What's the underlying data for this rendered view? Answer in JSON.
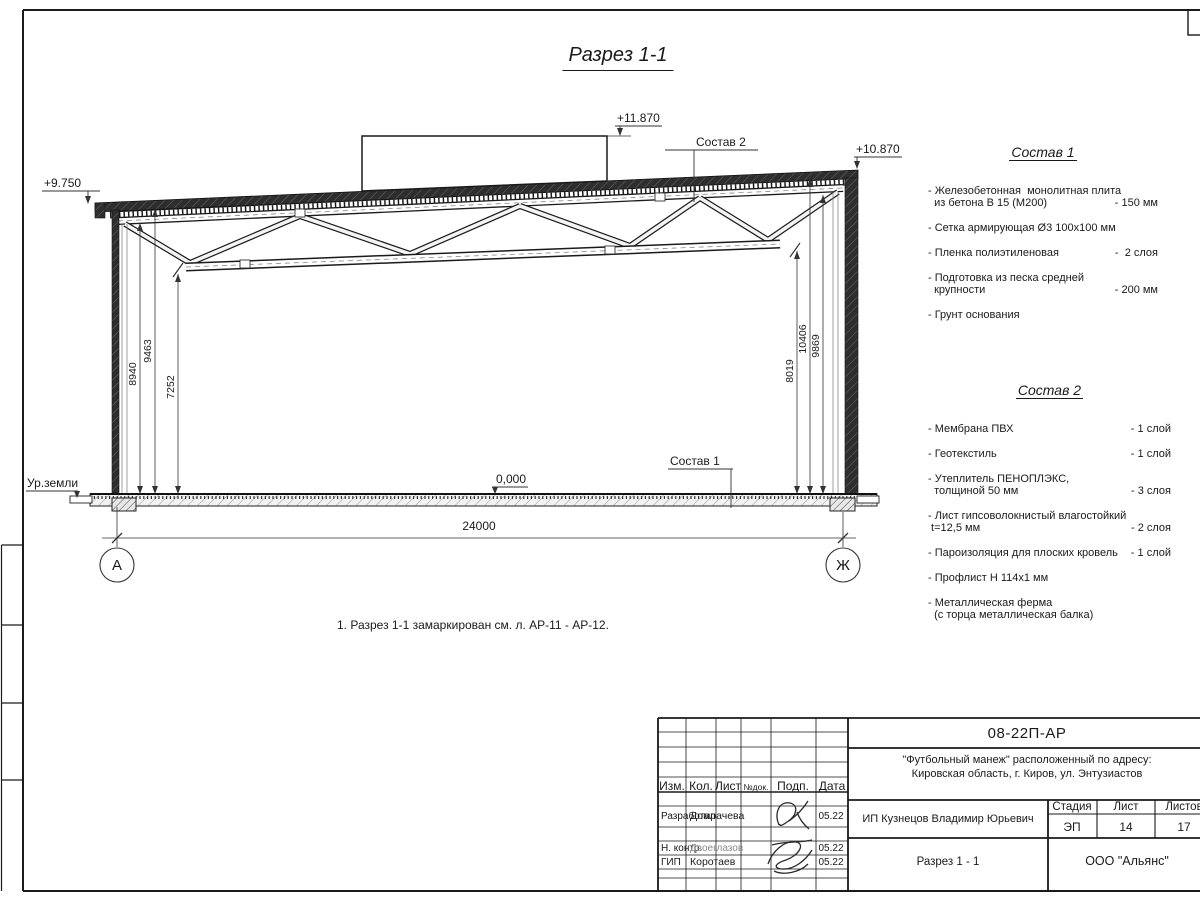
{
  "sheet": {
    "title": "Разрез 1-1",
    "note": "1. Разрез 1-1 замаркирован см. л. АР-11 - АР-12."
  },
  "drawing": {
    "elevations": {
      "left": "+9.750",
      "box": "+11.870",
      "right": "+10.870",
      "zero": "0,000"
    },
    "labels": {
      "ground": "Ур.земли",
      "sostav1_ref": "Состав 1",
      "sostav2_ref": "Состав 2"
    },
    "dims": {
      "span": "24000",
      "left": [
        "8940",
        "9463",
        "7252"
      ],
      "right": [
        "8019",
        "10406",
        "9869"
      ]
    },
    "axes": {
      "left": "А",
      "right": "Ж"
    }
  },
  "sostav1": {
    "title": "Состав 1",
    "items": [
      {
        "rows": [
          {
            "t": "- Железобетонная  монолитная плита",
            "q": ""
          },
          {
            "t": "  из бетона В 15 (М200)",
            "q": "- 150 мм"
          }
        ]
      },
      {
        "rows": [
          {
            "t": "- Сетка армирующая Ø3 100х100 мм",
            "q": ""
          }
        ]
      },
      {
        "rows": [
          {
            "t": "- Пленка полиэтиленовая",
            "q": "-  2 слоя"
          }
        ]
      },
      {
        "rows": [
          {
            "t": "- Подготовка из песка средней",
            "q": ""
          },
          {
            "t": "  крупности",
            "q": "- 200 мм"
          }
        ]
      },
      {
        "rows": [
          {
            "t": "- Грунт основания",
            "q": ""
          }
        ]
      }
    ]
  },
  "sostav2": {
    "title": "Состав 2",
    "items": [
      {
        "rows": [
          {
            "t": "- Мембрана ПВХ",
            "q": "- 1 слой"
          }
        ]
      },
      {
        "rows": [
          {
            "t": "- Геотекстиль",
            "q": "- 1 слой"
          }
        ]
      },
      {
        "rows": [
          {
            "t": "- Утеплитель ПЕНОПЛЭКС,",
            "q": ""
          },
          {
            "t": "  толщиной 50 мм",
            "q": "- 3 слоя"
          }
        ]
      },
      {
        "rows": [
          {
            "t": "- Лист гипсоволокнистый влагостойкий",
            "q": ""
          },
          {
            "t": " t=12,5 мм",
            "q": "- 2 слоя"
          }
        ]
      },
      {
        "rows": [
          {
            "t": "- Пароизоляция для плоских кровель",
            "q": "- 1 слой"
          }
        ]
      },
      {
        "rows": [
          {
            "t": "- Профлист Н 114х1 мм",
            "q": ""
          }
        ]
      },
      {
        "rows": [
          {
            "t": "- Металлическая ферма",
            "q": ""
          },
          {
            "t": "  (с торца металлическая балка)",
            "q": ""
          }
        ]
      }
    ]
  },
  "titleblock": {
    "doc_code": "08-22П-АР",
    "project_line1": "\"Футбольный манеж\" расположенный по адресу:",
    "project_line2": "Кировская область, г. Киров, ул. Энтузиастов",
    "cols": {
      "izm": "Изм.",
      "kol": "Кол.",
      "list": "Лист",
      "ndok": "№док.",
      "podp": "Подп.",
      "data": "Дата"
    },
    "rows": [
      {
        "role": "Разработал",
        "name": "Домрачева",
        "date": "05.22"
      },
      {
        "role": "Н. контр.",
        "name": "Двоеглазов",
        "date": "05.22"
      },
      {
        "role": "ГИП",
        "name": "Коротаев",
        "date": "05.22"
      }
    ],
    "client": "ИП Кузнецов Владимир Юрьевич",
    "stage_label": "Стадия",
    "sheet_label": "Лист",
    "sheets_label": "Листов",
    "stage": "ЭП",
    "sheet_no": "14",
    "sheets_total": "17",
    "drawing_name": "Разрез 1 - 1",
    "company": "ООО \"Альянс\""
  }
}
